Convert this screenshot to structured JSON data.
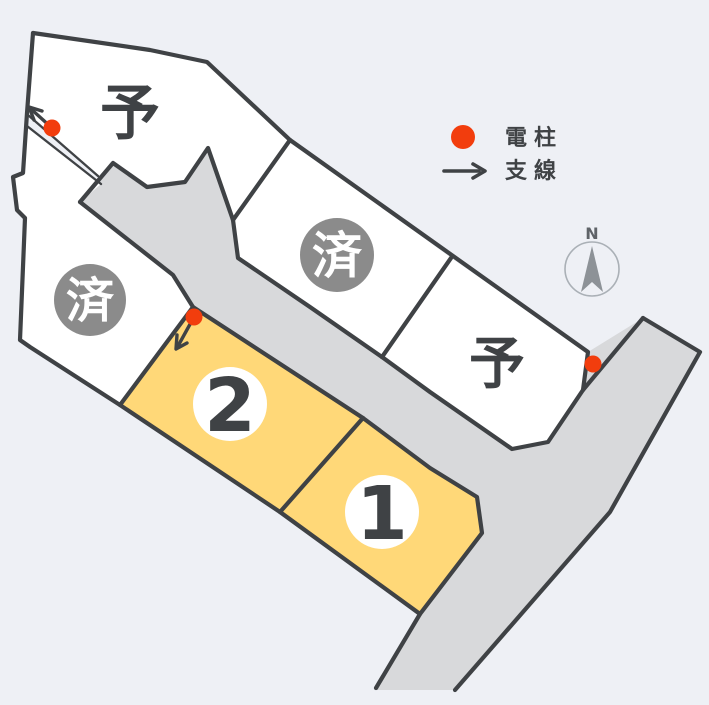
{
  "diagram": {
    "title": "site-lot-map",
    "lots": [
      {
        "id": "top-left",
        "label": "予",
        "status": "reserved"
      },
      {
        "id": "left",
        "label": "済",
        "status": "sold"
      },
      {
        "id": "center",
        "label": "済",
        "status": "sold"
      },
      {
        "id": "right",
        "label": "予",
        "status": "reserved"
      },
      {
        "id": "lot-2",
        "label": "2",
        "status": "available"
      },
      {
        "id": "lot-1",
        "label": "1",
        "status": "available"
      }
    ],
    "legend": {
      "pole_label": "電柱",
      "wire_label": "支線"
    },
    "compass": {
      "north_label": "N"
    },
    "colors": {
      "background": "#eef0f5",
      "lot_fill": "#ffffff",
      "road_fill": "#d8d9db",
      "line": "#3f4245",
      "available_fill": "#ffd878",
      "sold_badge_fill": "#8b8b8b",
      "badge_white": "#ffffff",
      "pole_red": "#f23d0d",
      "compass_gray": "#8d9297",
      "compass_ring": "#aab0b6"
    }
  }
}
